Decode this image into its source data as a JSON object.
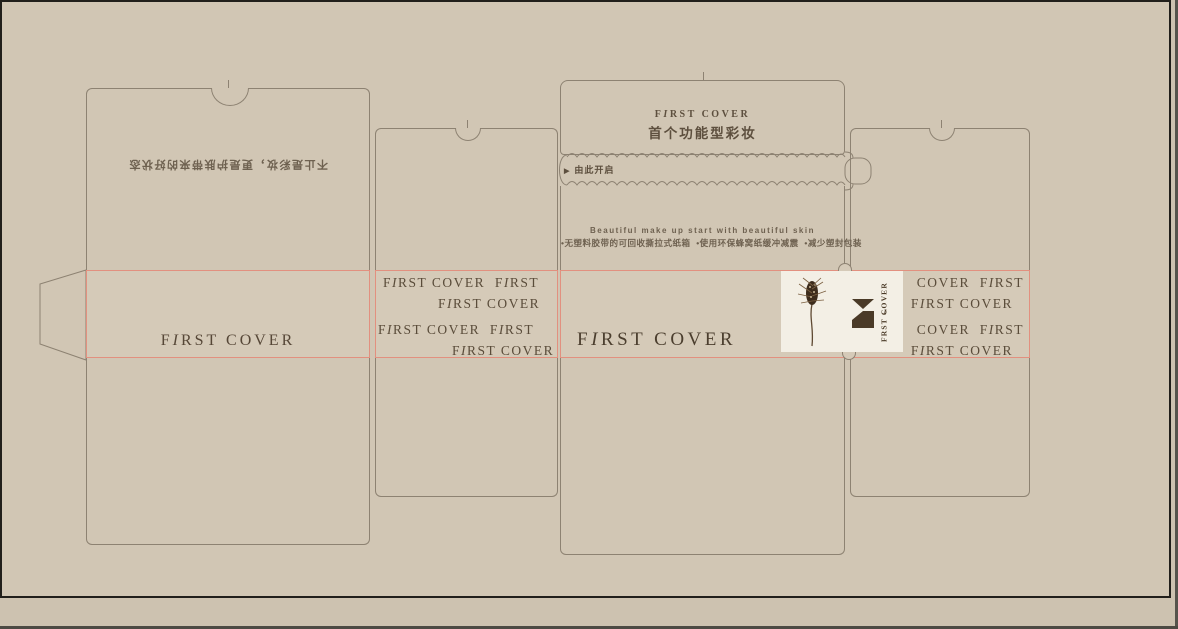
{
  "colors": {
    "background": "#d1c6b4",
    "dieline": "#8d8272",
    "fold_red": "#e2907f",
    "ink_brown": "#5a4c3a",
    "logo_brown": "#4a3a27",
    "card_white": "#f3efe5"
  },
  "left_flap": {
    "slogan": "不止是彩妆，更是护肤带来的好状态"
  },
  "top_panel": {
    "brand": "FIRST COVER",
    "tagline": "首个功能型彩妆"
  },
  "tear_strip": {
    "arrow": "▶",
    "label": "由此开启"
  },
  "eco_panel": {
    "line_en": "Beautiful make up start with beautiful skin",
    "line_zh": "•无塑料胶带的可回收撕拉式纸箱  •使用环保蜂窝纸缓冲减震  •减少塑封包装"
  },
  "side_panel_left": {
    "brand": "FIRST COVER"
  },
  "front_panel": {
    "brand": "FIRST COVER"
  },
  "pattern_left": [
    "FIRST COVER  FIRST",
    "FIRST COVER",
    "FIRST COVER  FIRST",
    "FIRST COVER"
  ],
  "pattern_right": [
    "COVER  FIRST",
    "FIRST COVER",
    "COVER  FIRST",
    "FIRST COVER"
  ],
  "logo_card": {
    "vertical_brand": "FIRST COVER"
  }
}
